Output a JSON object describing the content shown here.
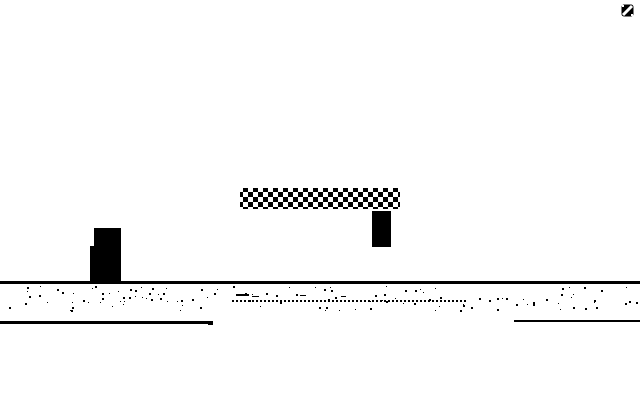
{
  "meta": {
    "app": "monochrome-platformer-game-screen",
    "bg_color": "#ffffff",
    "fg_color": "#000000"
  },
  "hud": {
    "score_value": "0",
    "score_icon": "slashed-zero-sprite",
    "score_rect": {
      "x": 621,
      "y": 2,
      "w": 13,
      "h": 13
    }
  },
  "scene": {
    "platform": {
      "pattern": "checker-dither",
      "rect": {
        "x": 240,
        "y": 188,
        "w": 160,
        "h": 21
      }
    },
    "enemy_block": {
      "rect": {
        "x": 372,
        "y": 211,
        "w": 19,
        "h": 36
      }
    },
    "player": {
      "body": {
        "x": 94,
        "y": 228,
        "w": 27,
        "h": 55
      },
      "foot": {
        "x": 90,
        "y": 246,
        "w": 4,
        "h": 37
      }
    },
    "ground": {
      "line": {
        "x": 0,
        "y": 281,
        "w": 640,
        "h": 3
      },
      "dotted_line": {
        "x": 232,
        "y": 300,
        "w": 236,
        "h": 2
      },
      "underline_left": {
        "x": 0,
        "y": 321,
        "w": 213,
        "h": 3
      },
      "underline_right": {
        "x": 514,
        "y": 320,
        "w": 126,
        "h": 2
      }
    }
  },
  "decor": {
    "speckle_seed": 7,
    "speckle_count": 130,
    "speckle_band": {
      "x": 2,
      "y": 286,
      "w": 636,
      "h": 25
    },
    "speckle_sizes": [
      1,
      2
    ],
    "dashes": [
      {
        "x": 236,
        "y": 294,
        "w": 13,
        "h": 2
      },
      {
        "x": 252,
        "y": 296,
        "w": 7,
        "h": 1
      },
      {
        "x": 300,
        "y": 295,
        "w": 6,
        "h": 1
      },
      {
        "x": 341,
        "y": 296,
        "w": 5,
        "h": 1
      },
      {
        "x": 208,
        "y": 322,
        "w": 5,
        "h": 3
      }
    ]
  }
}
